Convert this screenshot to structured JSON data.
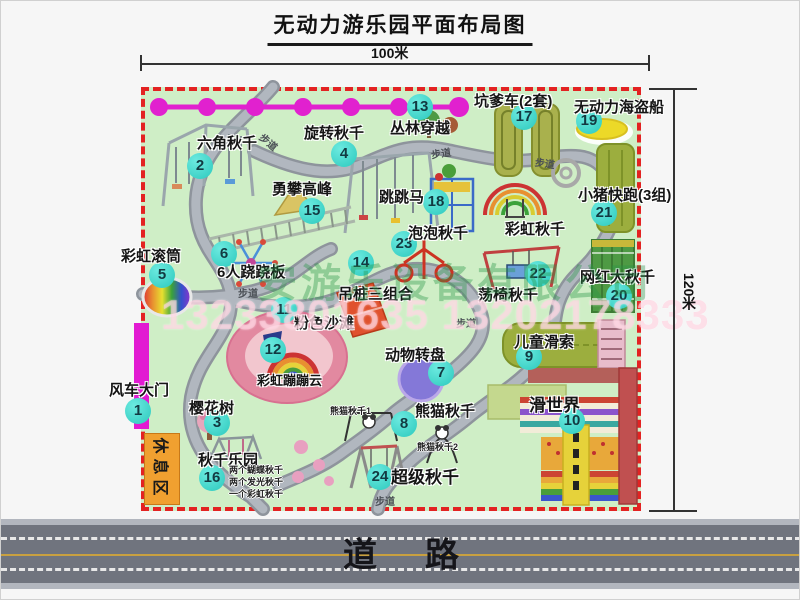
{
  "title": "无动力游乐园平面布局图",
  "dimensions": {
    "width_label": "100米",
    "height_label": "120米"
  },
  "road": {
    "label": "道路"
  },
  "rest_area": {
    "label": "休息区"
  },
  "path_label": "步道",
  "watermark": {
    "company": "安游乐设备有限公司",
    "phone": "13233801635 13202178333"
  },
  "extra_labels": {
    "rainbow_swing": "彩虹秋千",
    "panda_swing_1": "熊猫秋千1",
    "panda_swing_2": "熊猫秋千2",
    "swing_park_notes": [
      "两个蝴蝶秋千",
      "两个发光秋千",
      "一个彩虹秋千"
    ]
  },
  "attractions": [
    {
      "num": "1",
      "label": "风车大门"
    },
    {
      "num": "2",
      "label": "六角秋千"
    },
    {
      "num": "3",
      "label": "樱花树"
    },
    {
      "num": "4",
      "label": "旋转秋千"
    },
    {
      "num": "5",
      "label": "彩虹滚筒"
    },
    {
      "num": "6",
      "label": "6人跷跷板"
    },
    {
      "num": "7",
      "label": "动物转盘"
    },
    {
      "num": "8",
      "label": "熊猫秋千"
    },
    {
      "num": "9",
      "label": "儿童滑索"
    },
    {
      "num": "10",
      "label": "滑世界"
    },
    {
      "num": "11",
      "label": "粉色沙滩"
    },
    {
      "num": "12",
      "label": "彩虹蹦蹦云"
    },
    {
      "num": "13",
      "label": "丛林穿越"
    },
    {
      "num": "14",
      "label": "吊桩三组合"
    },
    {
      "num": "15",
      "label": "勇攀高峰"
    },
    {
      "num": "16",
      "label": "秋千乐园"
    },
    {
      "num": "17",
      "label": "坑爹车(2套)"
    },
    {
      "num": "18",
      "label": "跳跳马"
    },
    {
      "num": "19",
      "label": "无动力海盗船"
    },
    {
      "num": "20",
      "label": "网红大秋千"
    },
    {
      "num": "21",
      "label": "小猪快跑(3组)"
    },
    {
      "num": "22",
      "label": "荡椅秋千"
    },
    {
      "num": "23",
      "label": "泡泡秋千"
    },
    {
      "num": "24",
      "label": "超级秋千"
    }
  ],
  "colors": {
    "park_green": "#cfeec6",
    "border_red": "#e32222",
    "badge_teal": "#3fd9ce",
    "zipline_magenta": "#e121cf",
    "gate_magenta": "#e21ad2",
    "rest_area_orange": "#f0a030"
  }
}
